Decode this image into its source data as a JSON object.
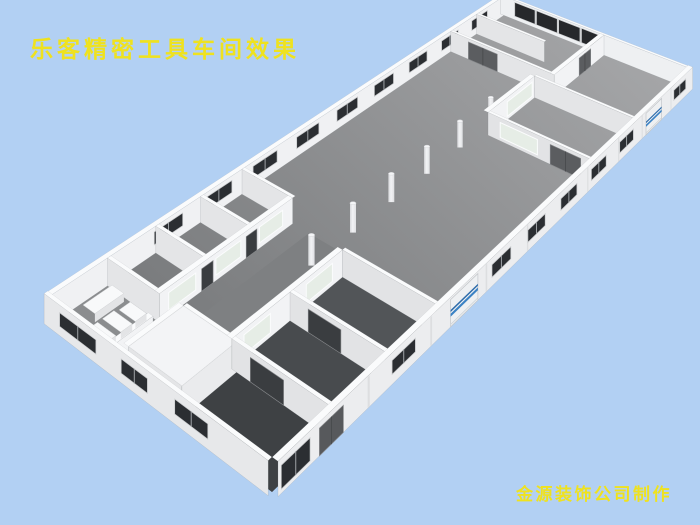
{
  "scene": {
    "title": "乐客精密工具车间效果",
    "credit": "金源装饰公司制作",
    "text_color": "#efe21e",
    "background_color": "#b2d0f3"
  },
  "palette": {
    "floor_dark": "#747678",
    "floor_light": "#a4a5a7",
    "wall_face": "#f0f1f3",
    "wall_top": "#fafbfc",
    "wall_shade": "#e4e5e7",
    "window_glass": "#2b2e32",
    "big_window_glass": "#26282b",
    "door_gray": "#5b5d60",
    "door_dark": "#3a3d40",
    "frosted_glass": "#e6ede6",
    "rolling_door_panel": "#eef0f2",
    "rolling_door_stripe1": "#3b82c4",
    "rolling_door_stripe2": "#2e6cab",
    "column_light": "#f2f3f5",
    "column_shade": "#d7d8db"
  }
}
